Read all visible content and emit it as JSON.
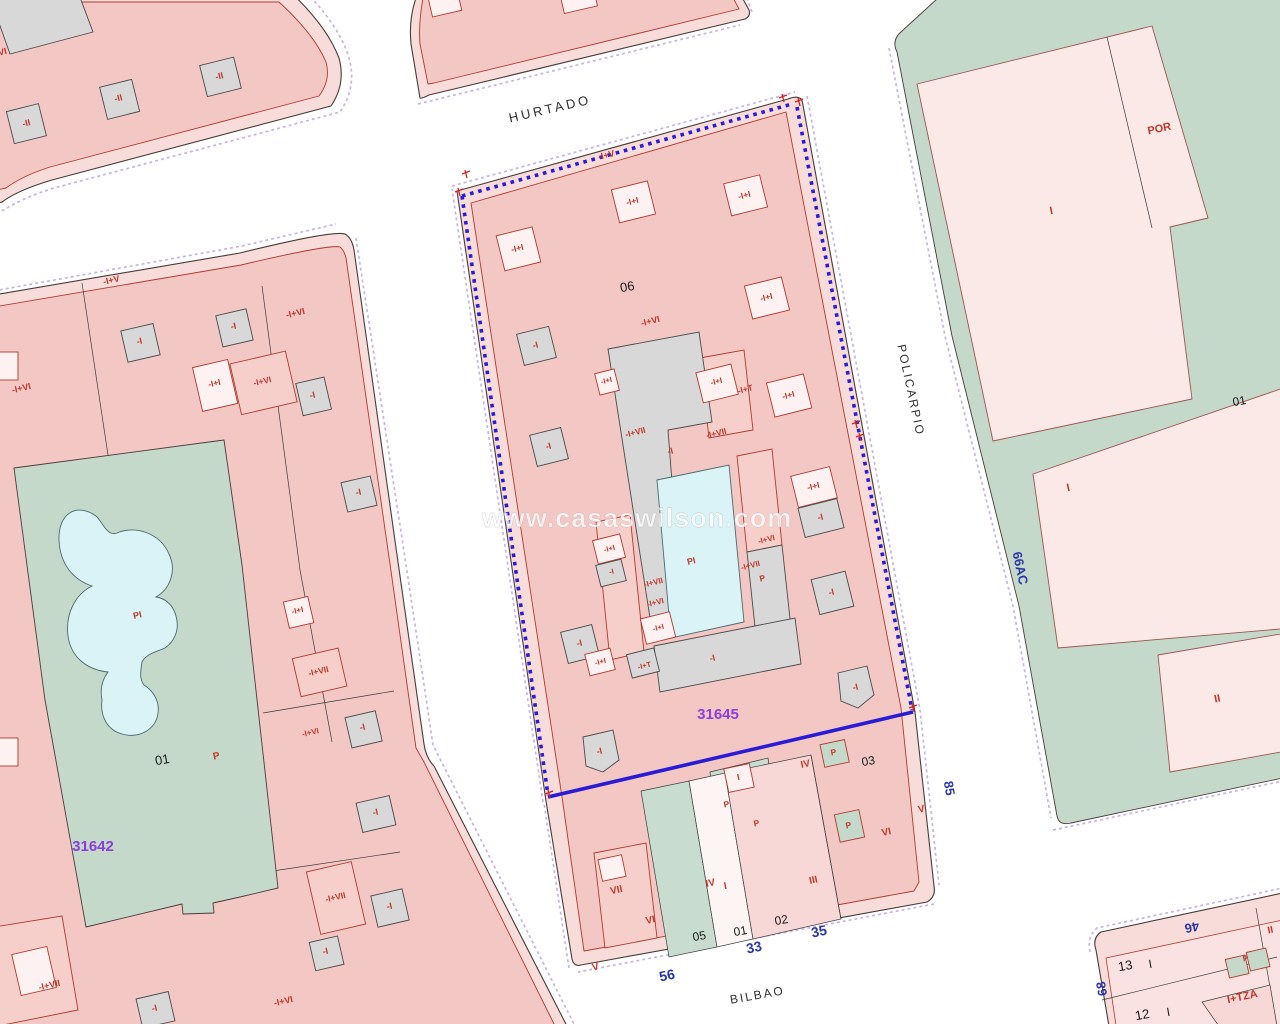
{
  "map": {
    "watermark": "www.casaswilson.com",
    "streets": [
      "HURTADO",
      "POLICARPIO",
      "BILBAO"
    ],
    "parcel_numbers": {
      "selected": "31645",
      "neighbor": "31642"
    },
    "house_numbers": [
      "56",
      "33",
      "35",
      "85",
      "46",
      "68",
      "66AC"
    ],
    "colors": {
      "selection_blue": "#2a1bd6",
      "parcel_number_purple": "#8b3fd9",
      "house_number_blue": "#2b35a8",
      "label_red": "#c0392b",
      "block_pink": "#f3c7c4",
      "block_band_pink": "#f8dcda",
      "building_gray": "#d8d8d8",
      "building_white": "#fdf1f1",
      "courtyard_green": "#c5d9cb",
      "pool_blue": "#daf3f6",
      "line_purple": "#c9b3e6",
      "outline_dark": "#4a3a3a"
    },
    "labels": [
      {
        "t": "-II",
        "x": 27,
        "y": 126,
        "r": -14,
        "c": "red",
        "s": 9
      },
      {
        "t": "-II",
        "x": 119,
        "y": 101,
        "r": -14,
        "c": "red",
        "s": 9
      },
      {
        "t": "-II",
        "x": 220,
        "y": 79,
        "r": -14,
        "c": "red",
        "s": 9
      },
      {
        "t": "-I+VI",
        "x": -2,
        "y": 56,
        "r": -14,
        "c": "red",
        "s": 9
      },
      {
        "t": "-I+V",
        "x": 112,
        "y": 283,
        "r": -13,
        "c": "red",
        "s": 9
      },
      {
        "t": "-I+VI",
        "x": 296,
        "y": 316,
        "r": -13,
        "c": "red",
        "s": 9
      },
      {
        "t": "-I",
        "x": 140,
        "y": 344,
        "r": -13,
        "c": "red",
        "s": 9
      },
      {
        "t": "-I",
        "x": 234,
        "y": 329,
        "r": -13,
        "c": "red",
        "s": 9
      },
      {
        "t": "-I+I",
        "x": 215,
        "y": 386,
        "r": -13,
        "c": "red",
        "s": 8.5
      },
      {
        "t": "-I+VI",
        "x": 263,
        "y": 384,
        "r": -13,
        "c": "red",
        "s": 8.5
      },
      {
        "t": "-I",
        "x": 313,
        "y": 398,
        "r": -13,
        "c": "red",
        "s": 9
      },
      {
        "t": "-I+VI",
        "x": 22,
        "y": 391,
        "r": -13,
        "c": "red",
        "s": 9
      },
      {
        "t": "-I",
        "x": 359,
        "y": 495,
        "r": -13,
        "c": "red",
        "s": 9
      },
      {
        "t": "PI",
        "x": 138,
        "y": 618,
        "r": -13,
        "c": "red",
        "s": 9
      },
      {
        "t": "01",
        "x": 163,
        "y": 764,
        "r": -10,
        "c": "black",
        "s": 13,
        "n": "parcel-number-01-left-block"
      },
      {
        "t": "P",
        "x": 217,
        "y": 759,
        "r": -13,
        "c": "red",
        "s": 10
      },
      {
        "t": "31642",
        "x": 93,
        "y": 851,
        "r": 0,
        "c": "purple",
        "s": 15,
        "n": "parcel-number-31642"
      },
      {
        "t": "-I+I",
        "x": 298,
        "y": 613,
        "r": -13,
        "c": "red",
        "s": 8
      },
      {
        "t": "-I+VII",
        "x": 319,
        "y": 674,
        "r": -13,
        "c": "red",
        "s": 8.5
      },
      {
        "t": "-I",
        "x": 363,
        "y": 730,
        "r": -13,
        "c": "red",
        "s": 9
      },
      {
        "t": "-I+VI",
        "x": 311,
        "y": 735,
        "r": -13,
        "c": "red",
        "s": 8
      },
      {
        "t": "-I",
        "x": 376,
        "y": 815,
        "r": -13,
        "c": "red",
        "s": 9
      },
      {
        "t": "-I+VII",
        "x": 336,
        "y": 900,
        "r": -13,
        "c": "red",
        "s": 8.5
      },
      {
        "t": "-I",
        "x": 390,
        "y": 909,
        "r": -13,
        "c": "red",
        "s": 9
      },
      {
        "t": "-I",
        "x": 326,
        "y": 954,
        "r": -13,
        "c": "red",
        "s": 9
      },
      {
        "t": "-I+VI",
        "x": 284,
        "y": 1004,
        "r": -13,
        "c": "red",
        "s": 9
      },
      {
        "t": "-I+VII",
        "x": 50,
        "y": 988,
        "r": -13,
        "c": "red",
        "s": 9
      },
      {
        "t": "-I",
        "x": 155,
        "y": 1011,
        "r": -13,
        "c": "red",
        "s": 9
      },
      {
        "t": "06",
        "x": 628,
        "y": 291,
        "r": -10,
        "c": "black",
        "s": 13,
        "n": "parcel-number-06"
      },
      {
        "t": "-I+V",
        "x": 607,
        "y": 158,
        "r": -14,
        "c": "red",
        "s": 9
      },
      {
        "t": "-I+I",
        "x": 518,
        "y": 251,
        "r": -14,
        "c": "red",
        "s": 8.5
      },
      {
        "t": "-I+I",
        "x": 633,
        "y": 204,
        "r": -14,
        "c": "red",
        "s": 8.5
      },
      {
        "t": "-I+I",
        "x": 745,
        "y": 198,
        "r": -14,
        "c": "red",
        "s": 8.5
      },
      {
        "t": "-I+I",
        "x": 767,
        "y": 300,
        "r": -14,
        "c": "red",
        "s": 8.5
      },
      {
        "t": "-I+I",
        "x": 789,
        "y": 398,
        "r": -14,
        "c": "red",
        "s": 8.5
      },
      {
        "t": "-I",
        "x": 536,
        "y": 348,
        "r": -14,
        "c": "red",
        "s": 9
      },
      {
        "t": "-I",
        "x": 549,
        "y": 449,
        "r": -14,
        "c": "red",
        "s": 9
      },
      {
        "t": "-I",
        "x": 580,
        "y": 646,
        "r": -14,
        "c": "red",
        "s": 9
      },
      {
        "t": "-I",
        "x": 600,
        "y": 754,
        "r": -14,
        "c": "red",
        "s": 9
      },
      {
        "t": "-I",
        "x": 832,
        "y": 595,
        "r": -14,
        "c": "red",
        "s": 9
      },
      {
        "t": "-I",
        "x": 856,
        "y": 690,
        "r": -14,
        "c": "red",
        "s": 9
      },
      {
        "t": "-I+I",
        "x": 814,
        "y": 489,
        "r": -14,
        "c": "red",
        "s": 8.5
      },
      {
        "t": "-I",
        "x": 821,
        "y": 520,
        "r": -14,
        "c": "red",
        "s": 9
      },
      {
        "t": "-I+VI",
        "x": 651,
        "y": 324,
        "r": -14,
        "c": "red",
        "s": 9
      },
      {
        "t": "-I+I",
        "x": 607,
        "y": 383,
        "r": -14,
        "c": "red",
        "s": 7.5
      },
      {
        "t": "-I+I",
        "x": 717,
        "y": 384,
        "r": -14,
        "c": "red",
        "s": 8
      },
      {
        "t": "-I+T",
        "x": 746,
        "y": 392,
        "r": -14,
        "c": "red",
        "s": 8.5
      },
      {
        "t": "-I+VII",
        "x": 636,
        "y": 435,
        "r": -14,
        "c": "red",
        "s": 8.5
      },
      {
        "t": "-I+VII",
        "x": 717,
        "y": 436,
        "r": -14,
        "c": "red",
        "s": 8.5
      },
      {
        "t": "-I",
        "x": 671,
        "y": 454,
        "r": -14,
        "c": "red",
        "s": 9
      },
      {
        "t": "PI",
        "x": 692,
        "y": 564,
        "r": -14,
        "c": "red",
        "s": 9
      },
      {
        "t": "-I+VI",
        "x": 767,
        "y": 542,
        "r": -14,
        "c": "red",
        "s": 8
      },
      {
        "t": "-I+VII",
        "x": 751,
        "y": 568,
        "r": -14,
        "c": "red",
        "s": 8
      },
      {
        "t": "P",
        "x": 763,
        "y": 581,
        "r": -14,
        "c": "red",
        "s": 8.5
      },
      {
        "t": "-I+VII",
        "x": 654,
        "y": 585,
        "r": -14,
        "c": "red",
        "s": 8
      },
      {
        "t": "-I+VI",
        "x": 656,
        "y": 605,
        "r": -14,
        "c": "red",
        "s": 8
      },
      {
        "t": "-I+I",
        "x": 610,
        "y": 551,
        "r": -14,
        "c": "red",
        "s": 7.5
      },
      {
        "t": "-I",
        "x": 612,
        "y": 574,
        "r": -14,
        "c": "red",
        "s": 7.5
      },
      {
        "t": "-I+I",
        "x": 659,
        "y": 630,
        "r": -14,
        "c": "red",
        "s": 7.5
      },
      {
        "t": "-I+I",
        "x": 601,
        "y": 664,
        "r": -14,
        "c": "red",
        "s": 7.5
      },
      {
        "t": "-I+T",
        "x": 645,
        "y": 668,
        "r": -14,
        "c": "red",
        "s": 7.5
      },
      {
        "t": "-I",
        "x": 713,
        "y": 661,
        "r": -14,
        "c": "red",
        "s": 9
      },
      {
        "t": "31645",
        "x": 718,
        "y": 719,
        "r": 0,
        "c": "purple",
        "s": 15,
        "n": "parcel-number-31645"
      },
      {
        "t": "VII",
        "x": 617,
        "y": 893,
        "r": -12,
        "c": "red",
        "s": 10
      },
      {
        "t": "VI",
        "x": 651,
        "y": 923,
        "r": -12,
        "c": "red",
        "s": 10
      },
      {
        "t": "V",
        "x": 596,
        "y": 970,
        "r": -12,
        "c": "red",
        "s": 10
      },
      {
        "t": "05",
        "x": 700,
        "y": 940,
        "r": -10,
        "c": "black",
        "s": 12,
        "n": "parcel-number-05"
      },
      {
        "t": "01",
        "x": 741,
        "y": 935,
        "r": -10,
        "c": "black",
        "s": 12,
        "n": "parcel-number-01"
      },
      {
        "t": "02",
        "x": 782,
        "y": 924,
        "r": -10,
        "c": "black",
        "s": 12,
        "n": "parcel-number-02"
      },
      {
        "t": "03",
        "x": 869,
        "y": 765,
        "r": -10,
        "c": "black",
        "s": 12,
        "n": "parcel-number-03"
      },
      {
        "t": "I",
        "x": 726,
        "y": 889,
        "r": -12,
        "c": "red",
        "s": 10
      },
      {
        "t": "I",
        "x": 739,
        "y": 780,
        "r": -12,
        "c": "red",
        "s": 9
      },
      {
        "t": "IV",
        "x": 711,
        "y": 886,
        "r": -12,
        "c": "red",
        "s": 10
      },
      {
        "t": "III",
        "x": 814,
        "y": 883,
        "r": -12,
        "c": "red",
        "s": 10
      },
      {
        "t": "IV",
        "x": 806,
        "y": 767,
        "r": -12,
        "c": "red",
        "s": 10
      },
      {
        "t": "VI",
        "x": 887,
        "y": 835,
        "r": -12,
        "c": "red",
        "s": 10
      },
      {
        "t": "V",
        "x": 922,
        "y": 812,
        "r": -12,
        "c": "red",
        "s": 10
      },
      {
        "t": "P",
        "x": 834,
        "y": 755,
        "r": -12,
        "c": "red",
        "s": 8.5
      },
      {
        "t": "P",
        "x": 849,
        "y": 828,
        "r": -12,
        "c": "red",
        "s": 8.5
      },
      {
        "t": "P",
        "x": 727,
        "y": 807,
        "r": -12,
        "c": "red",
        "s": 8.5
      },
      {
        "t": "P",
        "x": 757,
        "y": 826,
        "r": -12,
        "c": "red",
        "s": 8.5
      },
      {
        "t": "POR",
        "x": 1160,
        "y": 132,
        "r": -12,
        "c": "red",
        "s": 11
      },
      {
        "t": "I",
        "x": 1052,
        "y": 214,
        "r": -12,
        "c": "red",
        "s": 11
      },
      {
        "t": "01",
        "x": 1240,
        "y": 405,
        "r": -10,
        "c": "black",
        "s": 12,
        "n": "parcel-number-01-right-block"
      },
      {
        "t": "I",
        "x": 1069,
        "y": 491,
        "r": -12,
        "c": "red",
        "s": 11
      },
      {
        "t": "II",
        "x": 1218,
        "y": 702,
        "r": -12,
        "c": "red",
        "s": 11
      },
      {
        "t": "66AC",
        "x": 1016,
        "y": 569,
        "r": 78,
        "c": "blue",
        "s": 13,
        "n": "street-number-66ac"
      },
      {
        "t": "56",
        "x": 668,
        "y": 980,
        "r": -12,
        "c": "blue",
        "s": 14,
        "n": "house-number-56"
      },
      {
        "t": "33",
        "x": 755,
        "y": 952,
        "r": -12,
        "c": "blue",
        "s": 14,
        "n": "house-number-33"
      },
      {
        "t": "35",
        "x": 820,
        "y": 936,
        "r": -12,
        "c": "blue",
        "s": 14,
        "n": "house-number-35"
      },
      {
        "t": "85",
        "x": 945,
        "y": 789,
        "r": 80,
        "c": "blue",
        "s": 13,
        "n": "house-number-85"
      },
      {
        "t": "46",
        "x": 1191,
        "y": 923,
        "r": 168,
        "c": "blue",
        "s": 13,
        "n": "house-number-46"
      },
      {
        "t": "68",
        "x": 1106,
        "y": 988,
        "r": -100,
        "c": "blue",
        "s": 13,
        "n": "house-number-68"
      },
      {
        "t": "13",
        "x": 1126,
        "y": 970,
        "r": -10,
        "c": "black",
        "s": 13,
        "n": "parcel-number-13"
      },
      {
        "t": "I",
        "x": 1151,
        "y": 968,
        "r": -10,
        "c": "black",
        "s": 12
      },
      {
        "t": "12",
        "x": 1143,
        "y": 1019,
        "r": -10,
        "c": "black",
        "s": 13,
        "n": "parcel-number-12"
      },
      {
        "t": "I",
        "x": 1169,
        "y": 1016,
        "r": -10,
        "c": "black",
        "s": 12
      },
      {
        "t": "I+TZA",
        "x": 1243,
        "y": 1000,
        "r": -12,
        "c": "red",
        "s": 11
      },
      {
        "t": "II",
        "x": 1271,
        "y": 933,
        "r": -12,
        "c": "red",
        "s": 10
      },
      {
        "t": "P",
        "x": 1246,
        "y": 961,
        "r": -12,
        "c": "red",
        "s": 8
      },
      {
        "t": "HURTADO",
        "x": 551,
        "y": 113,
        "r": -13,
        "c": "street",
        "s": 13,
        "ls": 3,
        "n": "street-name-hurtado"
      },
      {
        "t": "POLICARPIO",
        "x": 907,
        "y": 391,
        "r": 78,
        "c": "street",
        "s": 12,
        "ls": 2,
        "n": "street-name-policarpio"
      },
      {
        "t": "BILBAO",
        "x": 758,
        "y": 999,
        "r": -10,
        "c": "street",
        "s": 12,
        "ls": 2,
        "n": "street-name-bilbao"
      }
    ]
  }
}
